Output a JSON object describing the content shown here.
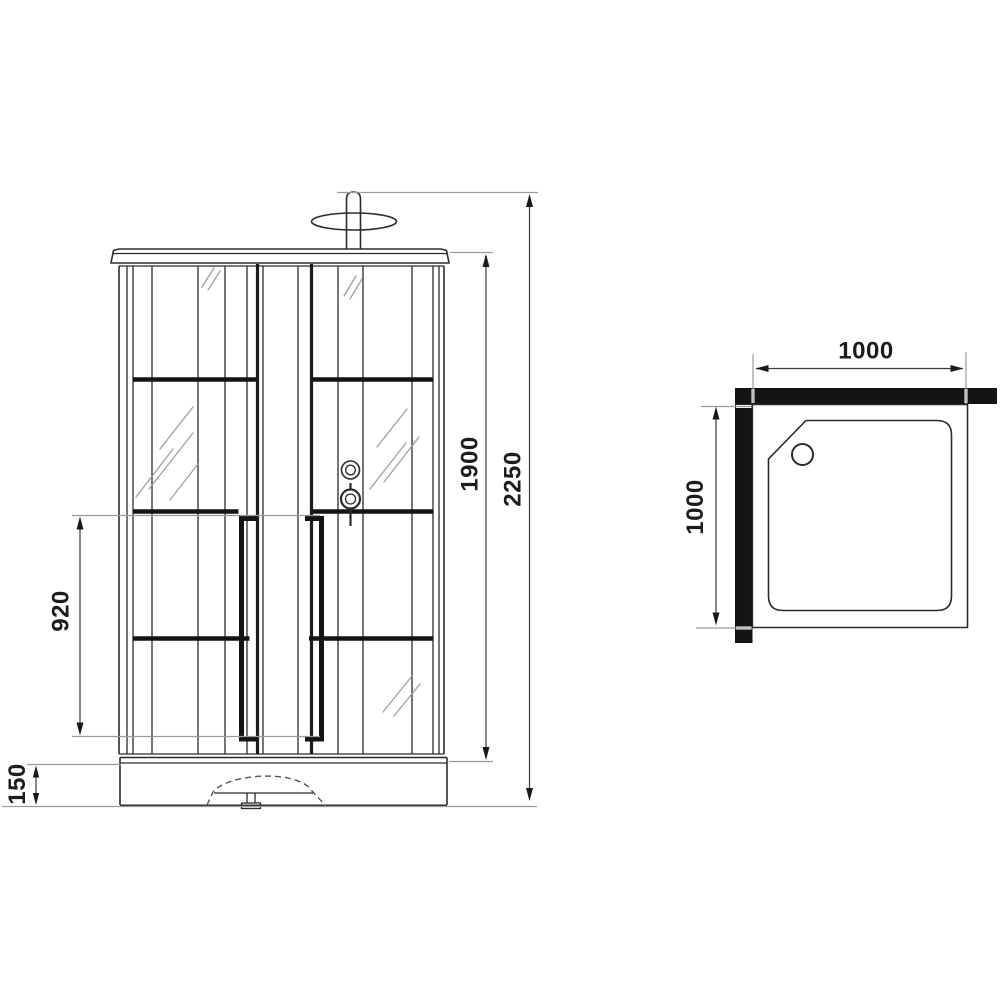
{
  "drawing": {
    "type": "shower-cabin-technical-drawing",
    "views": {
      "front": "front elevation",
      "top": "plan view of tray"
    },
    "dimensions": {
      "front": {
        "total_height": "2250",
        "cabin_height": "1900",
        "handle_height": "920",
        "tray_height": "150"
      },
      "top": {
        "width": "1000",
        "depth": "1000"
      }
    },
    "colors": {
      "background": "#ffffff",
      "main_line": "#2b2b2b",
      "accent_black": "#141414",
      "extension_gray": "#9a9a9a",
      "label_text": "#1c1c1c"
    }
  }
}
